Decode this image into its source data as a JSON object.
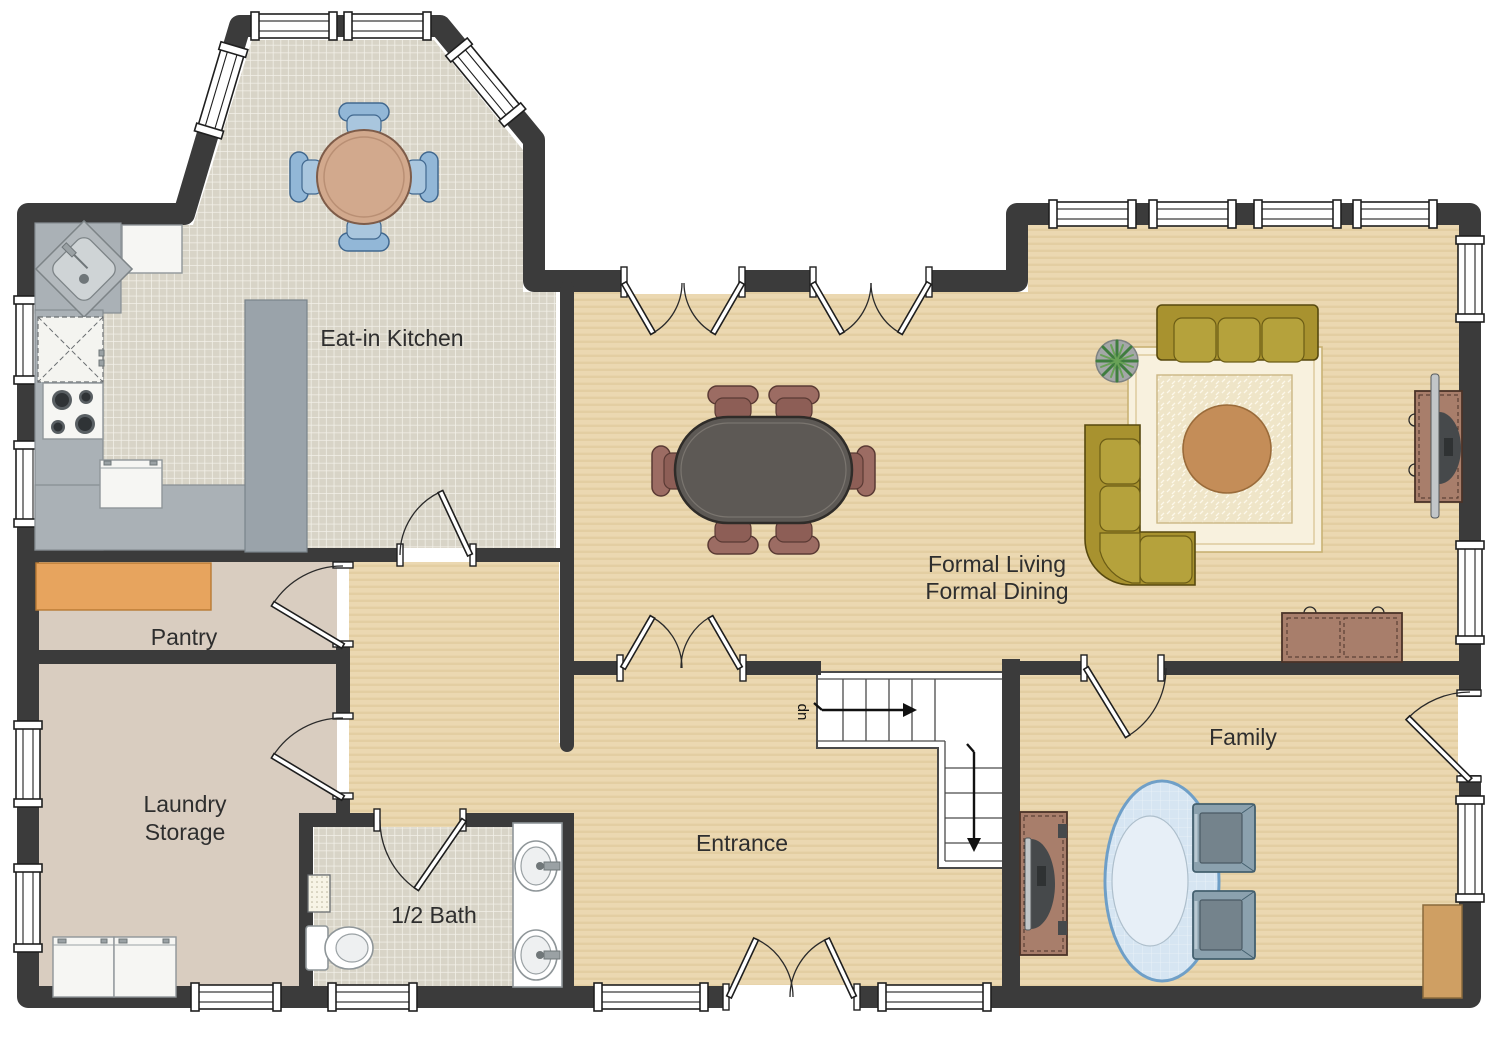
{
  "floorplan": {
    "rooms": {
      "kitchen": {
        "label": "Eat-in Kitchen"
      },
      "formal": {
        "line1": "Formal Living",
        "line2": "Formal Dining"
      },
      "pantry": {
        "label": "Pantry"
      },
      "laundry": {
        "line1": "Laundry",
        "line2": "Storage"
      },
      "half_bath": {
        "label": "1/2 Bath"
      },
      "entrance": {
        "label": "Entrance"
      },
      "family": {
        "label": "Family"
      }
    },
    "stairs": {
      "label": "up"
    },
    "colors": {
      "wall": "#3b3b3b",
      "floor_tile": "#d8d4c7",
      "floor_tile_grout": "#f3f1e9",
      "floor_tan": "#ebd8b1",
      "floor_tan_stripe": "#e3cea2",
      "floor_taupe": "#d9cdc0",
      "counter": "#aab1b6",
      "island": "#9aa3aa",
      "shelf_orange": "#e7a45e",
      "sofa_olive": "#a8922f",
      "table_dark": "#5d5955",
      "chair_maroon": "#9c6c63",
      "chair_blue": "#92b7d7",
      "wood_brown": "#a87e6b",
      "rug_cream": "#f8f1de",
      "rug_blue": "#d6e5f2",
      "family_chair": "#8ba1ae",
      "accent_tan": "#cf9f63"
    }
  }
}
